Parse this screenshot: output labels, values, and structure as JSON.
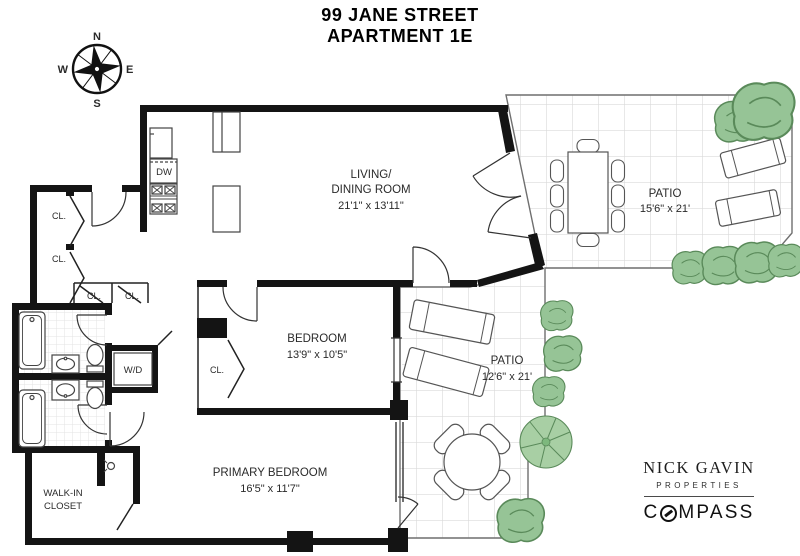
{
  "title": {
    "line1": "99 JANE STREET",
    "line2": "APARTMENT 1E"
  },
  "compass_rose": {
    "n": "N",
    "e": "E",
    "s": "S",
    "w": "W"
  },
  "rooms": {
    "living": {
      "name1": "LIVING/",
      "name2": "DINING ROOM",
      "dims": "21'1\" x 13'11\""
    },
    "patio_upper": {
      "name": "PATIO",
      "dims": "15'6\" x 21'"
    },
    "bedroom": {
      "name": "BEDROOM",
      "dims": "13'9\" x 10'5\""
    },
    "patio_lower": {
      "name": "PATIO",
      "dims": "12'6\" x 21'"
    },
    "primary_bedroom": {
      "name": "PRIMARY BEDROOM",
      "dims": "16'5\" x 11'7\""
    },
    "walk_in_closet": {
      "name1": "WALK-IN",
      "name2": "CLOSET"
    }
  },
  "labels": {
    "closet": "CL.",
    "dishwasher": "DW",
    "washer_dryer": "W/D"
  },
  "branding": {
    "agent": "NICK GAVIN",
    "agent_sub": "PROPERTIES",
    "brokerage_first": "C",
    "brokerage_rest": "MPASS"
  },
  "colors": {
    "wall": "#141414",
    "patio_grid": "#d9d9d9",
    "plant_green": "#96c496",
    "text": "#2a2a2a"
  }
}
